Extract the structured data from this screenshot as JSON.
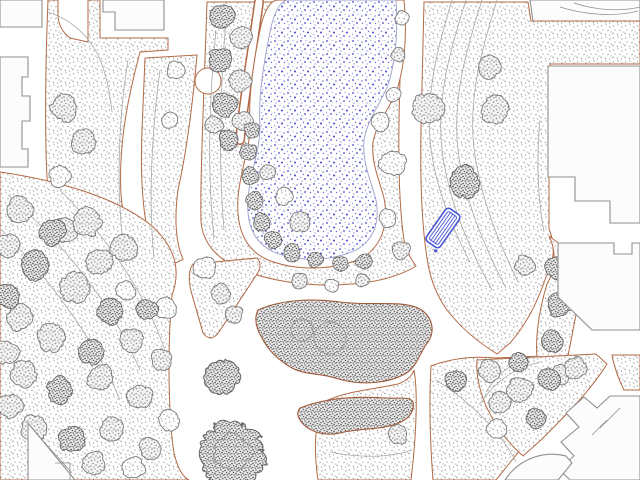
{
  "viewport": {
    "kind": "cad-landscape-site-plan",
    "width": 640,
    "height": 480,
    "background": "#ffffff"
  },
  "colors": {
    "path_edge": "#b26a46",
    "bed_edge": "#a05c3a",
    "building_outline": "#8f8f8f",
    "building_fill": "#fcfcfc",
    "contour": "#a8a8a8",
    "tree_outline": "#7a7a7a",
    "tree_outline_dark": "#646464",
    "shrub_clump_outline": "#6a6a6a",
    "water_edge": "#9aa0c8",
    "water_dot_a": "#4444cc",
    "water_dot_b": "#7070dd",
    "water_dot_c": "#a0a0e8",
    "grass_dot_a": "#a3a3a3",
    "grass_dot_b": "#8f8f8f",
    "canopy_dot": "#8b8b8b",
    "shrub_dot": "#636363",
    "bench": "#4a58d4",
    "white": "#ffffff"
  },
  "features": {
    "grass_areas": [
      {
        "id": "grass-topleft-strip",
        "d": "M48,0 L58,0 L58,14 C58,24 62,32 70,38 L88,42 L88,0 L100,0 L100,38 L168,38 L168,50 L140,52 C130,90 118,140 121,195 C125,240 143,270 166,290 C148,307 112,305 84,287 C58,269 47,218 46,150 C45,100 46,50 48,0 Z"
      },
      {
        "id": "grass-top-strip-2",
        "d": "M145,58 L197,55 C193,100 187,150 178,190 C174,220 176,244 183,259 C173,267 163,263 155,251 C143,230 140,180 142,130 C143,105 144,80 145,58 Z"
      },
      {
        "id": "grass-pond-block",
        "d": "M207,2 L402,2 L400,80 C398,140 398,200 404,240 C406,250 410,258 416,266 C400,276 378,282 352,284 C308,288 262,280 234,266 C218,258 203,244 201,222 C200,180 204,90 207,2 Z"
      },
      {
        "id": "grass-east-block",
        "d": "M424,2 L528,2 L531,21 L640,21 L640,64 L550,64 L549,177 L549,229 C556,245 554,263 546,277 C538,301 526,325 510,343 L497,354 C478,342 460,327 447,310 C437,296 431,281 428,264 C422,230 420,180 421,128 C422,85 423,42 424,2 Z"
      },
      {
        "id": "grass-southeast-block",
        "d": "M431,366 C452,358 474,356 496,358 L541,356 C549,380 541,421 521,449 L496,480 L433,480 C430,442 429,402 431,366 Z"
      },
      {
        "id": "grass-south-strip",
        "d": "M318,480 C313,446 315,416 326,401 C346,391 376,389 398,384 C406,381 412,376 414,370 C418,392 416,432 413,462 L411,480 Z"
      },
      {
        "id": "grass-junction-wedge",
        "d": "M193,264 L257,258 C261,262 261,268 257,274 L221,329 C215,339 209,341 203,333 L191,291 C188,279 189,269 193,264 Z"
      },
      {
        "id": "grass-east-wedge",
        "d": "M549,236 C557,252 555,270 547,284 C539,310 533,344 539,372 C542,386 549,394 557,398 C565,378 571,338 579,300 C583,280 589,258 597,245 L561,245 C557,242 553,239 549,236 Z"
      },
      {
        "id": "grass-se-triangle",
        "d": "M477,360 L596,354 L607,364 C591,390 566,415 541,440 L523,456 C505,440 491,420 483,398 C478,384 476,372 477,360 Z"
      },
      {
        "id": "grass-se-small",
        "d": "M612,355 L640,355 L640,390 L624,390 C618,378 614,366 612,355 Z"
      },
      {
        "id": "grass-southwest-mass",
        "d": "M0,172 C55,180 115,196 152,226 C176,248 181,271 172,295 C168,340 168,395 172,438 C174,462 181,476 189,480 L0,480 Z"
      }
    ],
    "white_paths": [
      {
        "id": "pond-left-path",
        "d": "M259,2 C251,60 243,105 240,140",
        "width": 7,
        "edge_width": 10
      }
    ],
    "path_bulb": {
      "cx": 208,
      "cy": 81,
      "r": 13
    },
    "pond": {
      "collar_d": "M278,0 L404,0 C407,32 405,64 397,90 C389,110 377,122 373,142 C371,162 378,176 384,198 C389,224 382,246 362,258 C333,271 296,271 268,260 C245,250 236,228 238,198 C240,170 250,150 250,126 C248,96 254,60 260,30 C264,10 271,0 278,0 Z",
      "water_d": "M287,0 L396,0 C398,30 396,60 388,85 C380,105 368,118 364,140 C362,162 370,178 376,200 C380,222 374,240 356,250 C330,262 298,262 274,252 C254,243 246,224 248,198 C250,172 260,152 260,126 C258,96 264,62 270,32 C274,12 280,2 287,0 Z"
    },
    "shrub_beds": [
      {
        "id": "shrub-bed-large",
        "d": "M258,310 C280,300 310,298 340,302 C370,306 400,300 418,308 C432,315 436,330 428,342 C420,352 418,364 408,372 C390,384 360,386 335,378 C320,373 305,375 292,368 C278,360 268,350 262,338 C256,328 254,318 258,310 Z"
      },
      {
        "id": "shrub-bed-band",
        "d": "M300,408 C325,398 355,396 385,398 C400,399 410,396 413,402 C415,412 408,420 396,424 C380,430 360,428 340,433 C322,437 306,430 300,420 C297,415 297,412 300,408 Z"
      }
    ],
    "bed_rings": [
      {
        "cx": 330,
        "cy": 338,
        "r": 16
      },
      {
        "cx": 302,
        "cy": 330,
        "r": 11
      }
    ],
    "dark_round_trees": [
      {
        "cx": 222,
        "cy": 378,
        "r": 17
      },
      {
        "cx": 233,
        "cy": 455,
        "r": 32,
        "inner_r": 18
      }
    ],
    "trees": [
      [
        64,
        108,
        13,
        "m"
      ],
      [
        84,
        142,
        12,
        "m"
      ],
      [
        60,
        176,
        11,
        "l"
      ],
      [
        66,
        230,
        12,
        "m"
      ],
      [
        100,
        262,
        13,
        "m"
      ],
      [
        126,
        291,
        10,
        "l"
      ],
      [
        176,
        70,
        9,
        "l"
      ],
      [
        170,
        120,
        8,
        "l"
      ],
      [
        222,
        16,
        12,
        "d"
      ],
      [
        241,
        38,
        11,
        "m"
      ],
      [
        220,
        60,
        12,
        "d"
      ],
      [
        240,
        82,
        11,
        "m"
      ],
      [
        224,
        104,
        12,
        "d"
      ],
      [
        243,
        122,
        10,
        "m"
      ],
      [
        229,
        140,
        10,
        "d"
      ],
      [
        214,
        125,
        9,
        "m"
      ],
      [
        300,
        222,
        10,
        "m"
      ],
      [
        284,
        196,
        9,
        "l"
      ],
      [
        268,
        172,
        8,
        "m"
      ],
      [
        402,
        18,
        7,
        "l"
      ],
      [
        398,
        55,
        7,
        "m"
      ],
      [
        393,
        95,
        8,
        "l"
      ],
      [
        380,
        122,
        9,
        "l"
      ],
      [
        393,
        163,
        13,
        "l"
      ],
      [
        388,
        218,
        9,
        "l"
      ],
      [
        402,
        250,
        9,
        "m"
      ],
      [
        428,
        108,
        15,
        "m"
      ],
      [
        495,
        110,
        14,
        "m"
      ],
      [
        490,
        67,
        11,
        "m"
      ],
      [
        465,
        182,
        15,
        "d"
      ],
      [
        525,
        265,
        10,
        "m"
      ],
      [
        205,
        268,
        11,
        "l"
      ],
      [
        221,
        294,
        10,
        "m"
      ],
      [
        234,
        314,
        9,
        "m"
      ],
      [
        300,
        281,
        8,
        "m"
      ],
      [
        332,
        286,
        7,
        "l"
      ],
      [
        362,
        280,
        7,
        "m"
      ],
      [
        556,
        268,
        11,
        "d"
      ],
      [
        560,
        305,
        12,
        "d"
      ],
      [
        552,
        342,
        11,
        "d"
      ],
      [
        560,
        374,
        10,
        "m"
      ],
      [
        520,
        390,
        13,
        "m"
      ],
      [
        549,
        379,
        11,
        "d"
      ],
      [
        500,
        402,
        11,
        "m"
      ],
      [
        576,
        368,
        11,
        "m"
      ],
      [
        497,
        428,
        10,
        "l"
      ],
      [
        535,
        418,
        10,
        "d"
      ],
      [
        456,
        381,
        11,
        "d"
      ],
      [
        489,
        371,
        11,
        "m"
      ],
      [
        519,
        362,
        10,
        "d"
      ],
      [
        398,
        434,
        10,
        "m"
      ],
      [
        20,
        210,
        13,
        "m"
      ],
      [
        52,
        232,
        13,
        "d"
      ],
      [
        88,
        222,
        14,
        "m"
      ],
      [
        124,
        248,
        13,
        "m"
      ],
      [
        36,
        266,
        14,
        "d"
      ],
      [
        74,
        288,
        15,
        "m"
      ],
      [
        110,
        312,
        13,
        "d"
      ],
      [
        20,
        318,
        13,
        "m"
      ],
      [
        52,
        338,
        14,
        "m"
      ],
      [
        92,
        352,
        13,
        "d"
      ],
      [
        132,
        340,
        12,
        "m"
      ],
      [
        24,
        374,
        13,
        "m"
      ],
      [
        60,
        390,
        13,
        "d"
      ],
      [
        100,
        378,
        13,
        "m"
      ],
      [
        140,
        396,
        12,
        "m"
      ],
      [
        34,
        428,
        13,
        "m"
      ],
      [
        72,
        440,
        13,
        "d"
      ],
      [
        112,
        428,
        12,
        "m"
      ],
      [
        150,
        448,
        11,
        "m"
      ],
      [
        94,
        464,
        12,
        "m"
      ],
      [
        134,
        468,
        11,
        "l"
      ],
      [
        166,
        308,
        11,
        "l"
      ],
      [
        162,
        360,
        11,
        "m"
      ],
      [
        170,
        420,
        10,
        "l"
      ],
      [
        8,
        246,
        12,
        "m"
      ],
      [
        8,
        296,
        12,
        "d"
      ],
      [
        6,
        352,
        12,
        "m"
      ],
      [
        10,
        406,
        12,
        "m"
      ],
      [
        147,
        310,
        10,
        "d"
      ]
    ],
    "shrub_clumps": [
      [
        252,
        130,
        8
      ],
      [
        248,
        152,
        9
      ],
      [
        250,
        176,
        9
      ],
      [
        254,
        200,
        9
      ],
      [
        262,
        222,
        9
      ],
      [
        274,
        240,
        9
      ],
      [
        292,
        252,
        9
      ],
      [
        315,
        260,
        8
      ],
      [
        340,
        264,
        8
      ],
      [
        364,
        262,
        8
      ]
    ],
    "contours": [
      "M466,0 C450,50 436,100 442,150 C448,200 470,250 492,290",
      "M482,0 C466,50 452,100 458,150 C464,200 486,250 506,288",
      "M497,0 C482,48 468,98 474,148 C480,198 500,245 518,282",
      "M452,0 C438,46 426,92 430,140 C434,185 452,228 470,262",
      "M128,60 C120,110 116,170 122,235",
      "M160,70 C152,130 148,200 154,258",
      "M47,12 C75,20 95,42 103,68 C108,82 110,96 112,112",
      "M216,30 C209,100 207,170 214,238",
      "M226,20 C220,90 218,160 224,230",
      "M8,195 C60,240 110,300 140,370",
      "M2,230 C50,280 95,340 120,400",
      "M60,190 C110,240 150,300 168,360",
      "M486,392 C498,372 516,360 538,356",
      "M480,404 C494,382 514,368 540,362",
      "M436,380 C468,400 500,430 516,462",
      "M330,452 C360,458 390,458 412,450",
      "M540,120 C536,160 538,200 544,232"
    ],
    "buildings": [
      {
        "id": "building-topleft",
        "d": "M0,0 L42,0 L42,27 L0,27 Z",
        "lines": []
      },
      {
        "id": "building-topleft-2",
        "d": "M103,0 L164,0 L164,30 L115,30 L115,12 L103,12 Z",
        "lines": []
      },
      {
        "id": "building-left-edge",
        "d": "M0,57 L28,57 L28,77 L22,77 L22,96 L30,96 L30,121 L22,121 L22,149 L28,149 L28,167 L0,167 Z",
        "lines": []
      },
      {
        "id": "building-topright",
        "d": "M530,0 L640,0 L640,21 L533,21 Z",
        "lines": [
          "M560,7 C585,15 615,17 638,11",
          "M574,3 C595,10 620,12 640,7"
        ],
        "edge_line": "M533,21 L640,21"
      },
      {
        "id": "building-right-large",
        "d": "M548,66 L640,66 L640,223 L610,223 L610,201 L575,201 L575,177 L548,177 Z",
        "lines": []
      },
      {
        "id": "building-right-mid",
        "d": "M558,243 L614,243 L614,254 L632,254 L632,243 L640,243 L640,330 L592,330 L558,297 Z",
        "lines": []
      },
      {
        "id": "building-bottomright",
        "d": "M640,396 L610,396 L597,408 L584,397 L566,413 L579,427 L561,442 L574,456 L559,469 L570,480 L640,480 Z",
        "lines": [
          "M607,420 L592,435",
          "M620,408 L600,428"
        ]
      },
      {
        "id": "building-bottomright-annex",
        "d": "M505,480 C518,460 542,450 566,456 L572,463 L558,480 Z",
        "lines": []
      },
      {
        "id": "building-bottomleft",
        "d": "M28,423 L75,480 L28,480 Z",
        "lines": [
          "M44,442 L72,473",
          "M55,463 L70,463 L70,480"
        ]
      }
    ],
    "bench": {
      "cx": 443,
      "cy": 228,
      "length": 40,
      "width": 17,
      "angle_deg": -55,
      "slat_count": 3,
      "corner_dot": [
        -23,
        7
      ]
    }
  }
}
